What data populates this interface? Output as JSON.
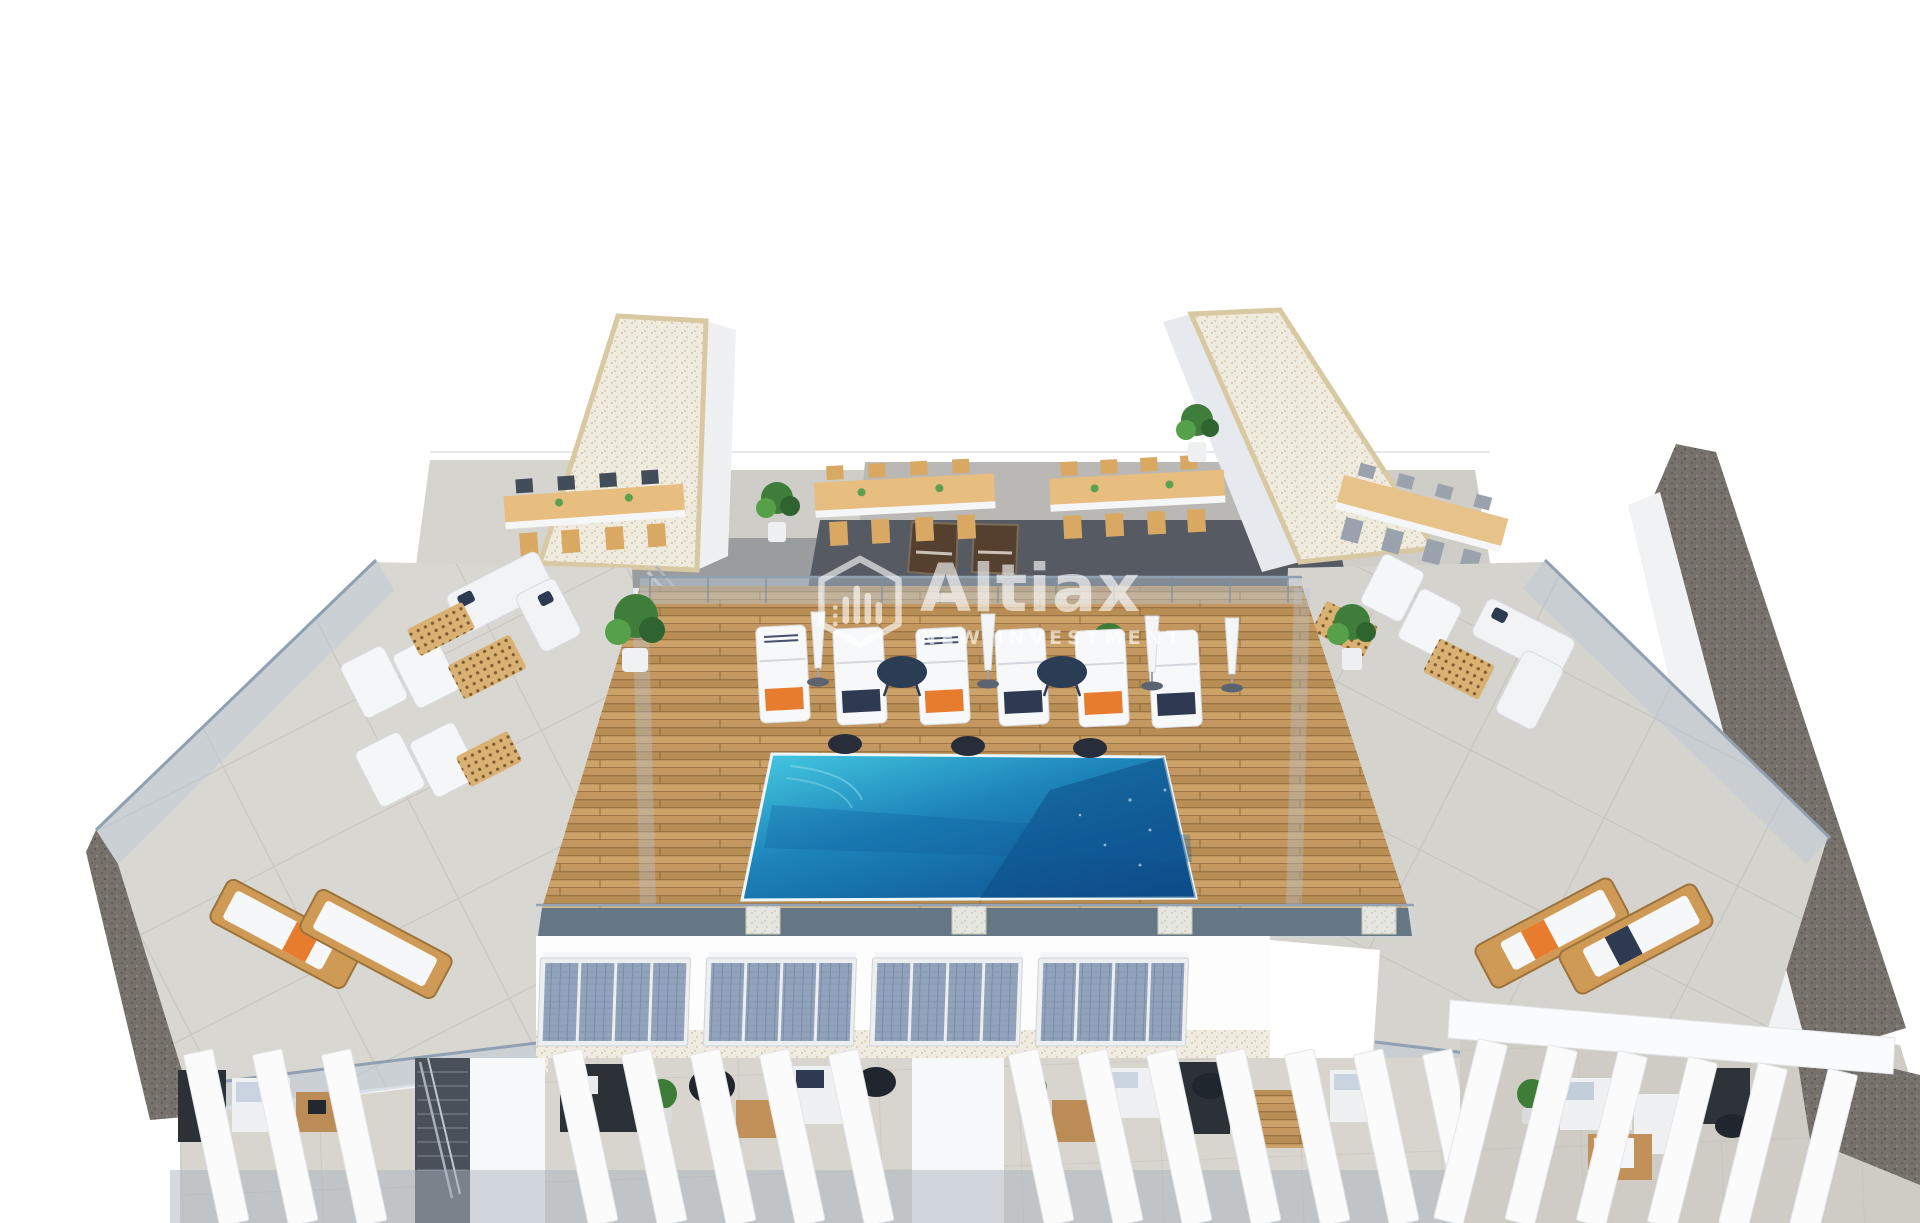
{
  "image": {
    "kind": "3d-architectural-render",
    "subject": "Aerial view of residential rooftop solarium with communal pool, sun loungers, dining terraces, solar panels and pergolas",
    "background": "#ffffff"
  },
  "watermark": {
    "brand": "Altiax",
    "tagline": "NEW INVESTMENT",
    "color": "#ffffff",
    "opacity": 0.62,
    "icon": "hexagon-buildings-logo"
  },
  "palette": {
    "pool_shallow": "#46cbe2",
    "pool_mid": "#1d84ba",
    "pool_deep": "#0d5191",
    "deck_wood": "#c49760",
    "furniture_wood": "#cf9a55",
    "concrete": "#d9d7d2",
    "charcoal_paving": "#565b63",
    "gravel_roof": "#f0ebdf",
    "gravel_slope": "#76726b",
    "solar_cell": "#93a3bc",
    "glass": "#b7c7d7",
    "towel_orange": "#e87c2e",
    "towel_navy": "#2e3a52",
    "plant_green": "#3f7d3b",
    "door_brown": "#55402f",
    "white_structure": "#fbfbfc",
    "lounger_white": "#f7f8f9"
  },
  "scene": {
    "pool_count": 1,
    "sun_loungers_poolside": 6,
    "umbrellas_closed": 4,
    "round_side_tables": 2,
    "dark_poufs": 3,
    "dining_tables": 4,
    "solar_panel_arrays": 4,
    "wooden_loungers_left_terrace": 2,
    "wooden_loungers_right_terrace": 2,
    "storage_doors": 2
  }
}
